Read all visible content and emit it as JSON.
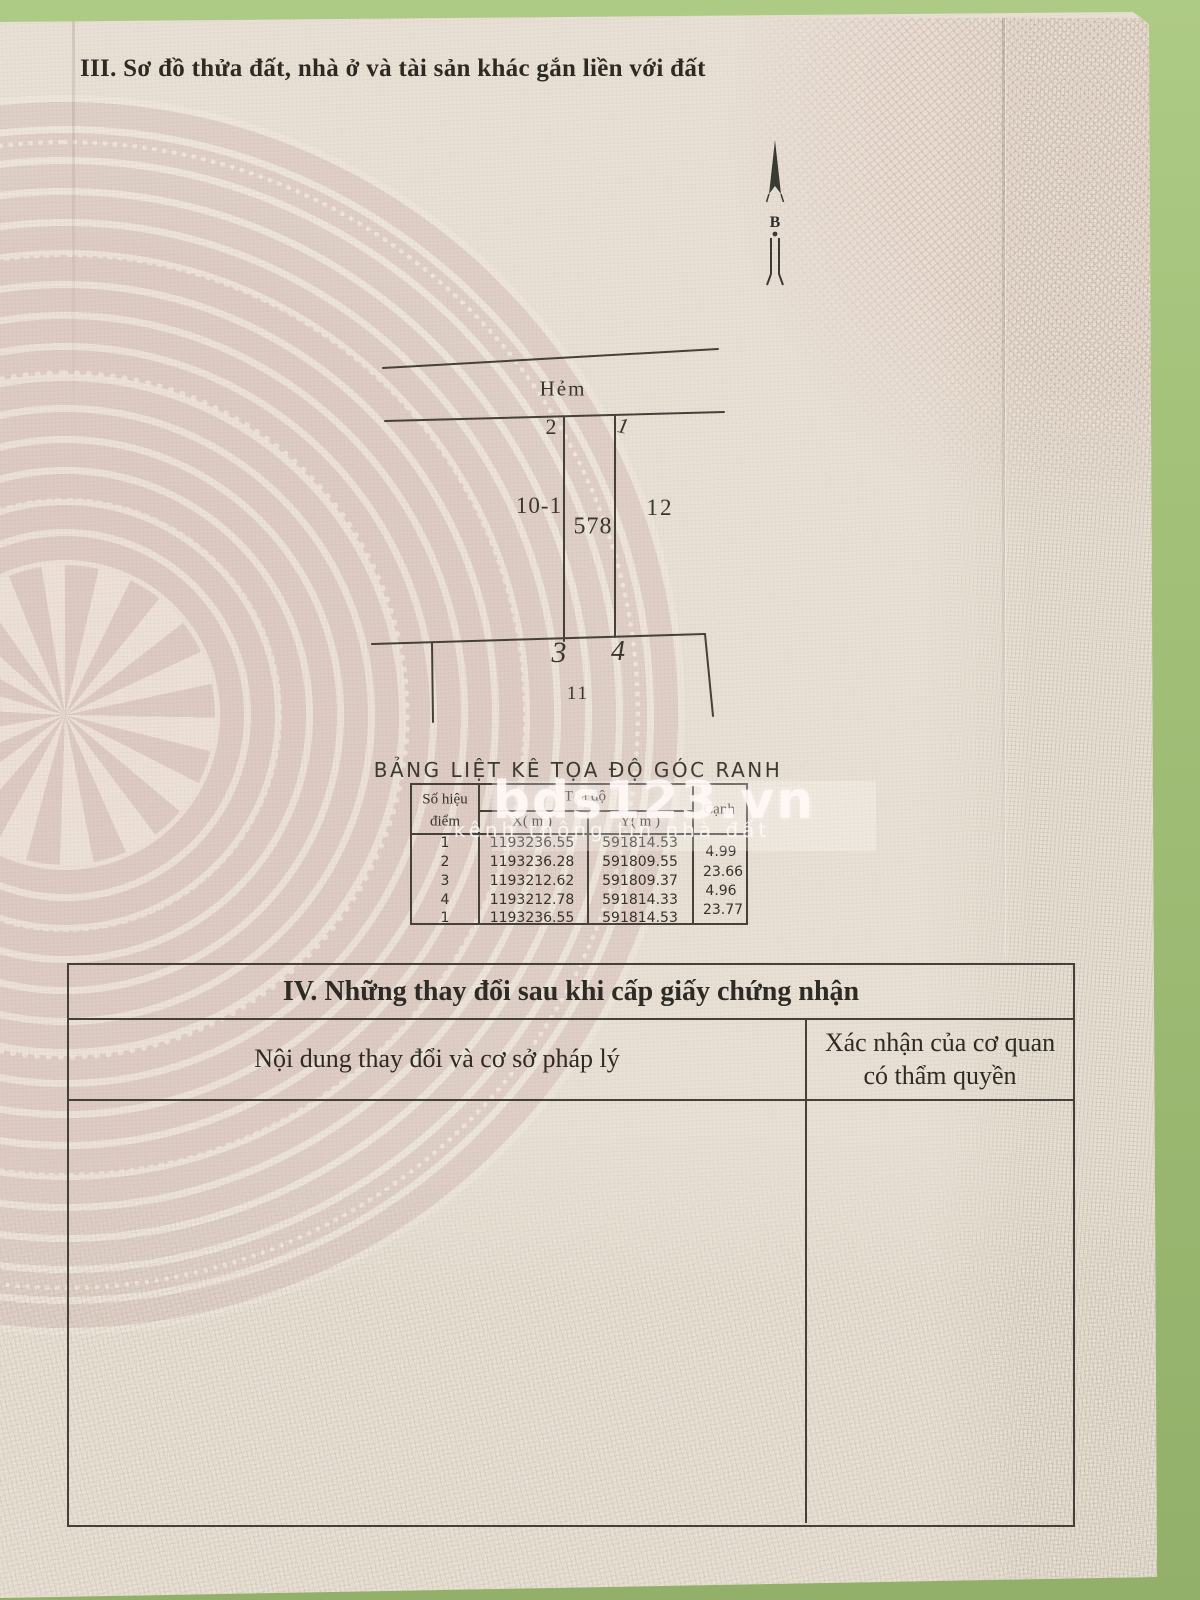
{
  "page": {
    "section3_title": "III. Sơ đồ thửa đất, nhà ở và tài sản khác gắn liền với đất",
    "north_label": "B"
  },
  "diagram": {
    "alley": "Hẻm",
    "point_top_left": "2",
    "point_top_right": "1",
    "point_bottom_left": "3",
    "point_bottom_right": "4",
    "parcel_left": "10-1",
    "parcel_center": "578",
    "parcel_right": "12",
    "parcel_bottom": "11"
  },
  "coordinate_table": {
    "title": "BẢNG LIỆT KÊ TỌA ĐỘ GÓC RANH",
    "headers": {
      "point_line1": "Số hiệu",
      "point_line2": "điểm",
      "coords": "Tọa độ",
      "x": "X( m )",
      "y": "Y( m )",
      "edge": "Cạnh"
    },
    "rows": [
      {
        "point": "1",
        "x": "1193236.55",
        "y": "591814.53"
      },
      {
        "point": "2",
        "x": "1193236.28",
        "y": "591809.55"
      },
      {
        "point": "3",
        "x": "1193212.62",
        "y": "591809.37"
      },
      {
        "point": "4",
        "x": "1193212.78",
        "y": "591814.33"
      },
      {
        "point": "1",
        "x": "1193236.55",
        "y": "591814.53"
      }
    ],
    "edges": [
      "4.99",
      "23.66",
      "4.96",
      "23.77"
    ]
  },
  "watermark": {
    "brand": "bds123.vn",
    "tagline": "kênh thông tin nhà đất"
  },
  "section4": {
    "title": "IV. Những thay đổi sau khi cấp giấy chứng nhận",
    "col_content": "Nội dung thay đổi và cơ sở pháp lý",
    "col_confirm_line1": "Xác nhận của cơ quan",
    "col_confirm_line2": "có thẩm quyền"
  },
  "colors": {
    "background_green": "#a3c179",
    "paper": "#e9e0d5",
    "drum_pink": "#d5bfb9",
    "ink": "#2f2b24"
  }
}
